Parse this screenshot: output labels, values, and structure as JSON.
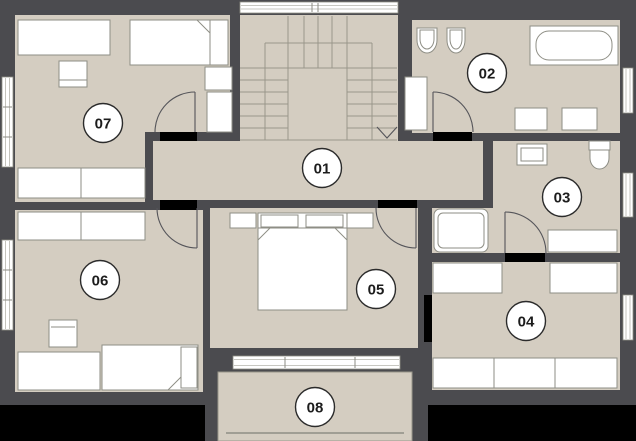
{
  "rooms": [
    {
      "number": "01"
    },
    {
      "number": "02"
    },
    {
      "number": "03"
    },
    {
      "number": "04"
    },
    {
      "number": "05"
    },
    {
      "number": "06"
    },
    {
      "number": "07"
    },
    {
      "number": "08"
    }
  ],
  "stairs": {
    "direction": "down"
  },
  "colors": {
    "wall": "#4b4b4f",
    "floor": "#d4cdc1",
    "furniture": "#ffffff",
    "outline": "#8e8e85",
    "door_gap": "#000000",
    "outside": "#000000",
    "label_bg": "#ffffff",
    "label_border": "#2b2b2b",
    "label_text": "#1c1c1c"
  }
}
